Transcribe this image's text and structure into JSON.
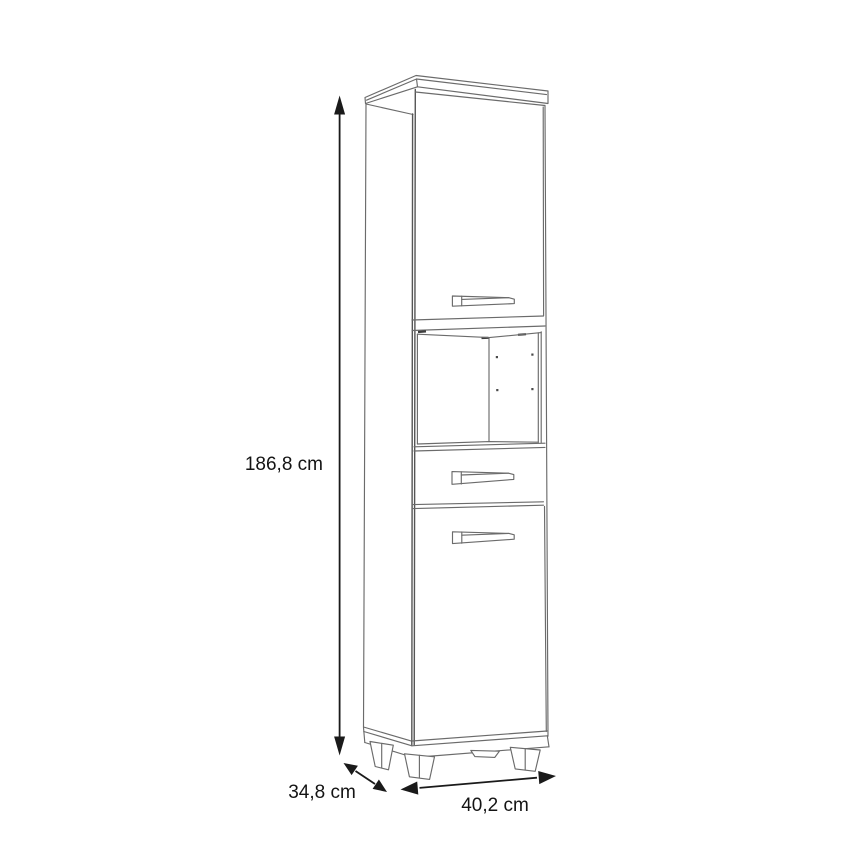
{
  "diagram": {
    "kind": "furniture dimension drawing",
    "subject": "tall cabinet with two doors, open shelf niche and one drawer, standing on four feet",
    "dimensions": {
      "height": {
        "value": "186,8",
        "unit": "cm",
        "label": "186,8 cm"
      },
      "depth": {
        "value": "34,8",
        "unit": "cm",
        "label": "34,8 cm"
      },
      "width": {
        "value": "40,2",
        "unit": "cm",
        "label": "40,2 cm"
      }
    },
    "colors": {
      "background": "#ffffff",
      "cabinet_line": "#6b6b6b",
      "dimension_line": "#1a1a1a",
      "label_text": "#141414"
    }
  }
}
